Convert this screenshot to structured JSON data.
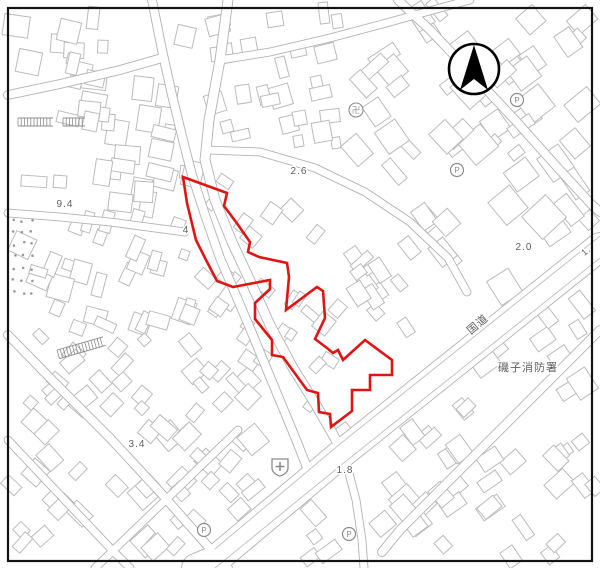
{
  "map": {
    "width": 600,
    "height": 568,
    "frame": {
      "x": 8,
      "y": 8,
      "w": 584,
      "h": 553,
      "color": "#141414",
      "stroke_width": 2.2
    },
    "palette": {
      "road_casing": "#b3b3b3",
      "road_fill": "#ffffff",
      "building_stroke": "#bcbcbc",
      "detail_line": "#c4c4c4",
      "label_color": "#5f5f5f",
      "symbol_color": "#8d8d8d",
      "boundary_red": "#e11414",
      "arrow_black": "#000000"
    },
    "north_arrow": {
      "cx": 474,
      "cy": 69,
      "r": 25,
      "apex_y": 45,
      "base_y": 90,
      "half_w": 14,
      "notch_y": 79
    },
    "boundary": {
      "stroke_width": 2.6,
      "points": [
        [
          183,
          177
        ],
        [
          227,
          193
        ],
        [
          224,
          206
        ],
        [
          236,
          222
        ],
        [
          250,
          242
        ],
        [
          248,
          252
        ],
        [
          259,
          257
        ],
        [
          287,
          263
        ],
        [
          289,
          277
        ],
        [
          286,
          310
        ],
        [
          317,
          287
        ],
        [
          323,
          291
        ],
        [
          325,
          318
        ],
        [
          315,
          339
        ],
        [
          327,
          348
        ],
        [
          333,
          353
        ],
        [
          338,
          350
        ],
        [
          343,
          360
        ],
        [
          365,
          340
        ],
        [
          392,
          360
        ],
        [
          392,
          375
        ],
        [
          370,
          375
        ],
        [
          370,
          390
        ],
        [
          352,
          390
        ],
        [
          352,
          411
        ],
        [
          331,
          427
        ],
        [
          330,
          414
        ],
        [
          319,
          412
        ],
        [
          318,
          393
        ],
        [
          307,
          390
        ],
        [
          283,
          357
        ],
        [
          272,
          355
        ],
        [
          272,
          340
        ],
        [
          255,
          319
        ],
        [
          255,
          303
        ],
        [
          270,
          289
        ],
        [
          270,
          280
        ],
        [
          233,
          287
        ],
        [
          217,
          281
        ],
        [
          205,
          258
        ],
        [
          196,
          240
        ],
        [
          187,
          203
        ]
      ]
    },
    "roads": [
      {
        "name": "national-route",
        "width": 28,
        "points": [
          [
            600,
            247
          ],
          [
            470,
            351
          ],
          [
            340,
            455
          ],
          [
            215,
            560
          ],
          [
            196,
            568
          ]
        ]
      },
      {
        "name": "se-parallel-street",
        "width": 8,
        "points": [
          [
            600,
            330
          ],
          [
            545,
            385
          ],
          [
            488,
            442
          ],
          [
            438,
            492
          ],
          [
            400,
            530
          ],
          [
            382,
            552
          ]
        ]
      },
      {
        "name": "shopping-street",
        "width": 9,
        "points": [
          [
            228,
            0
          ],
          [
            220,
            60
          ],
          [
            209,
            120
          ],
          [
            205,
            160
          ],
          [
            215,
            200
          ],
          [
            232,
            242
          ],
          [
            252,
            285
          ],
          [
            270,
            325
          ],
          [
            293,
            368
          ],
          [
            316,
            405
          ],
          [
            335,
            438
          ],
          [
            345,
            458
          ]
        ]
      },
      {
        "name": "west-street",
        "width": 8,
        "points": [
          [
            152,
            0
          ],
          [
            162,
            50
          ],
          [
            172,
            95
          ],
          [
            183,
            140
          ],
          [
            192,
            175
          ],
          [
            205,
            215
          ],
          [
            220,
            258
          ],
          [
            238,
            300
          ],
          [
            254,
            338
          ],
          [
            268,
            372
          ],
          [
            283,
            408
          ],
          [
            297,
            442
          ],
          [
            308,
            470
          ]
        ]
      },
      {
        "name": "south-connector",
        "width": 7,
        "points": [
          [
            345,
            458
          ],
          [
            356,
            500
          ],
          [
            362,
            540
          ],
          [
            364,
            568
          ]
        ]
      },
      {
        "name": "north-branch",
        "width": 7,
        "points": [
          [
            220,
            60
          ],
          [
            270,
            52
          ],
          [
            330,
            38
          ],
          [
            390,
            22
          ],
          [
            440,
            8
          ],
          [
            470,
            0
          ]
        ]
      },
      {
        "name": "east-branch",
        "width": 7,
        "points": [
          [
            207,
            150
          ],
          [
            260,
            152
          ],
          [
            315,
            168
          ],
          [
            365,
            192
          ],
          [
            410,
            222
          ],
          [
            448,
            258
          ],
          [
            467,
            292
          ]
        ]
      },
      {
        "name": "top-right-road",
        "width": 8,
        "points": [
          [
            398,
            0
          ],
          [
            430,
            30
          ],
          [
            470,
            72
          ],
          [
            515,
            120
          ],
          [
            558,
            168
          ],
          [
            592,
            205
          ],
          [
            600,
            212
          ]
        ]
      },
      {
        "name": "topleft-road-upper",
        "width": 8,
        "points": [
          [
            8,
            95
          ],
          [
            60,
            84
          ],
          [
            120,
            70
          ],
          [
            162,
            58
          ]
        ]
      },
      {
        "name": "topleft-road-lower",
        "width": 7,
        "points": [
          [
            8,
            213
          ],
          [
            60,
            217
          ],
          [
            110,
            222
          ],
          [
            155,
            228
          ],
          [
            185,
            232
          ]
        ]
      },
      {
        "name": "sw-diagonal-1",
        "width": 8,
        "points": [
          [
            8,
            335
          ],
          [
            55,
            383
          ],
          [
            110,
            438
          ],
          [
            160,
            492
          ],
          [
            205,
            543
          ],
          [
            228,
            568
          ]
        ]
      },
      {
        "name": "sw-diagonal-2",
        "width": 7,
        "points": [
          [
            8,
            440
          ],
          [
            60,
            495
          ],
          [
            112,
            550
          ],
          [
            130,
            568
          ]
        ]
      },
      {
        "name": "sw-cross",
        "width": 7,
        "points": [
          [
            95,
            568
          ],
          [
            150,
            515
          ],
          [
            205,
            462
          ],
          [
            238,
            430
          ]
        ]
      }
    ],
    "road_detail_lines": [
      [
        [
          600,
          236
        ],
        [
          470,
          340
        ],
        [
          340,
          444
        ],
        [
          215,
          549
        ]
      ],
      [
        [
          600,
          258
        ],
        [
          470,
          362
        ],
        [
          340,
          466
        ],
        [
          215,
          568
        ]
      ]
    ],
    "buildings": {
      "seed": 7,
      "regions": [
        [
          14,
          14,
          200,
          205,
          8,
          42,
          10,
          26
        ],
        [
          205,
          8,
          340,
          168,
          -12,
          26,
          9,
          22
        ],
        [
          348,
          8,
          588,
          198,
          -38,
          46,
          10,
          30
        ],
        [
          12,
          215,
          198,
          330,
          20,
          30,
          9,
          24
        ],
        [
          10,
          330,
          250,
          418,
          45,
          26,
          9,
          22
        ],
        [
          10,
          420,
          258,
          556,
          45,
          38,
          9,
          24
        ],
        [
          202,
          178,
          348,
          428,
          -52,
          30,
          8,
          20
        ],
        [
          348,
          198,
          462,
          330,
          -38,
          18,
          9,
          24
        ],
        [
          470,
          200,
          590,
          298,
          -38,
          6,
          14,
          34
        ],
        [
          300,
          432,
          595,
          558,
          -38,
          40,
          10,
          26
        ],
        [
          462,
          302,
          595,
          428,
          -38,
          12,
          10,
          26
        ]
      ]
    },
    "vegetation_dots": {
      "x": 12,
      "y": 218,
      "cols": 3,
      "rows": 7,
      "dx": 9,
      "dy": 12,
      "r": 1.3
    },
    "hatches": [
      {
        "x": 18,
        "y": 118,
        "w": 35,
        "h": 8,
        "rot": 0
      },
      {
        "x": 63,
        "y": 118,
        "w": 22,
        "h": 8,
        "rot": 0
      },
      {
        "x": 57,
        "y": 350,
        "w": 48,
        "h": 9,
        "rot": -16
      }
    ],
    "labels": [
      {
        "text": "9.4",
        "x": 65,
        "y": 207,
        "size": 10,
        "rot": 0
      },
      {
        "text": "4",
        "x": 186,
        "y": 233,
        "size": 10,
        "rot": 0
      },
      {
        "text": "2.6",
        "x": 299,
        "y": 174,
        "size": 10,
        "rot": 0
      },
      {
        "text": "2.0",
        "x": 524,
        "y": 250,
        "size": 10,
        "rot": 0
      },
      {
        "text": "1.8",
        "x": 345,
        "y": 473,
        "size": 10,
        "rot": 0
      },
      {
        "text": "3.4",
        "x": 137,
        "y": 447,
        "size": 10,
        "rot": 0
      },
      {
        "text": "1.",
        "x": 588,
        "y": 253,
        "size": 9,
        "rot": -40
      },
      {
        "text": "国道",
        "x": 480,
        "y": 327,
        "size": 11,
        "rot": -40
      },
      {
        "text": "磯子消防署",
        "x": 528,
        "y": 371,
        "size": 11,
        "rot": 0
      }
    ],
    "icons": [
      {
        "type": "parking",
        "x": 457,
        "y": 170
      },
      {
        "type": "parking",
        "x": 204,
        "y": 530
      },
      {
        "type": "parking",
        "x": 349,
        "y": 534
      },
      {
        "type": "parking",
        "x": 517,
        "y": 100
      },
      {
        "type": "temple",
        "x": 356,
        "y": 110
      },
      {
        "type": "hospital",
        "x": 280,
        "y": 467
      }
    ]
  }
}
